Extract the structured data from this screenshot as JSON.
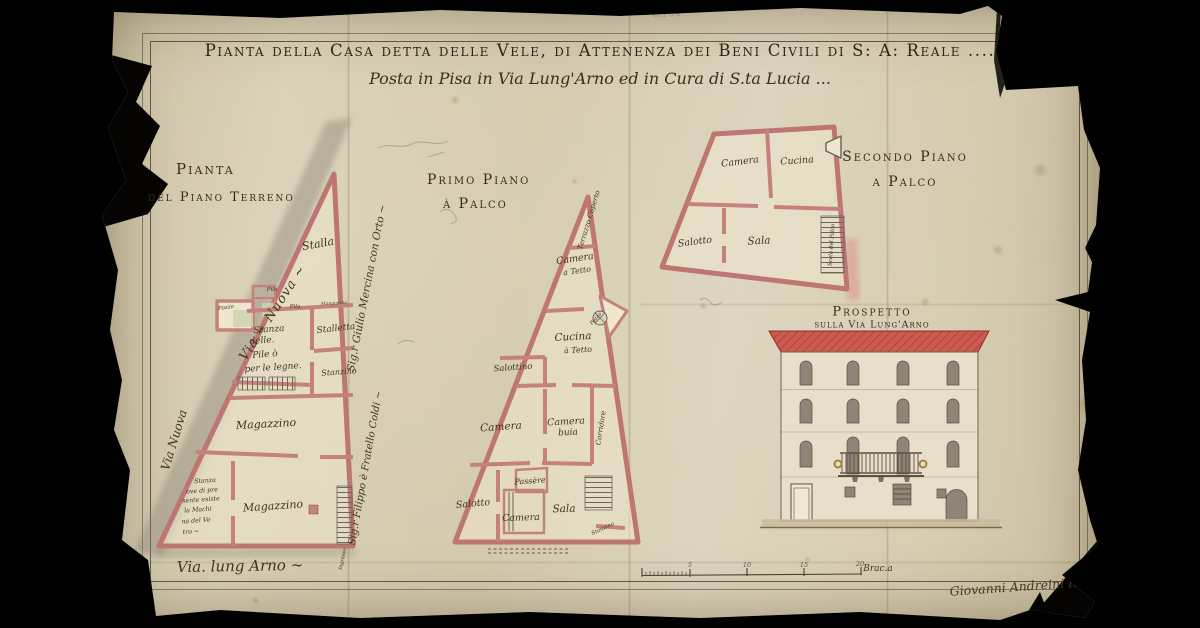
{
  "document": {
    "title": "Pianta della Casa detta delle Vele, di Attenenza dei Beni Civili di S: A: Reale ....",
    "subtitle": "Posta in Pisa in Via Lung'Arno ed in Cura di S.ta Lucia ...",
    "signature": "Giovanni Andreini Ing.e",
    "pencil_note": "6.104"
  },
  "plans": {
    "ground": {
      "heading": [
        "Pianta",
        "del Piano Terreno"
      ],
      "streets": {
        "via_nuova_upper": "Via ~ Nuova ~",
        "via_nuova_lower": "Via Nuova",
        "via_lungarno": "Via. lung Arno ~"
      },
      "neighbors": {
        "east_upper": "Sig.r Giulio Mercina con Orto ~",
        "east_lower": "Sig.r Filippo è Fratello Coldi ~"
      },
      "rooms": {
        "stalla": "Stalla",
        "pila_a": "Pila",
        "pila_b": "Pila",
        "pozzo": "Pozzo",
        "mangiatoia": "Mangiatoia",
        "stanza_pile": [
          "Stanza",
          "delle.",
          "Pile ò",
          "per le legne."
        ],
        "stalletta": "Stalletta",
        "stanzino": "Stanzino",
        "magazzino_a": "Magazzino",
        "magazzino_b": "Magazzino",
        "stanza_macchina": [
          "Stanza",
          "ove di pre",
          "sente esiste",
          "la Machi",
          "na del Ve",
          "tro ~"
        ],
        "ingresso": "Ingresso"
      }
    },
    "first": {
      "heading": [
        "Primo Piano",
        "à Palco"
      ],
      "rooms": {
        "terrazzo": "Terrazzo Coperto",
        "camera_tetto": [
          "Camera",
          "a Tetto"
        ],
        "cucina_tetto": [
          "Cucina",
          "à Tetto"
        ],
        "pozzo": "Pozzo",
        "salottino": "Salottino",
        "camera": "Camera",
        "camera_buia": [
          "Camera",
          "buia"
        ],
        "corridore": "Corridore",
        "passere": "Passère",
        "salotto": "Salotto",
        "camera_b": "Camera",
        "sala": "Sala",
        "stanzino": "Stanzino"
      }
    },
    "second": {
      "heading": [
        "Secondo Piano",
        "a Palco"
      ],
      "rooms": {
        "camera": "Camera",
        "cucina": "Cucina",
        "salotto": "Salotto",
        "sala": "Sala",
        "scala": "Scala del Palco"
      }
    }
  },
  "elevation": {
    "heading": [
      "Prospetto",
      "sulla Via Lung'Arno"
    ]
  },
  "scale_bar": {
    "tick_labels": [
      "5",
      "10",
      "15",
      "20"
    ],
    "unit": "Brac.a"
  },
  "colors": {
    "paper": "#d8cfb6",
    "wall_pink": "#c5827d",
    "roof_red": "#cd5a50",
    "ink": "#3c3224",
    "window_gray": "#8d8577"
  }
}
